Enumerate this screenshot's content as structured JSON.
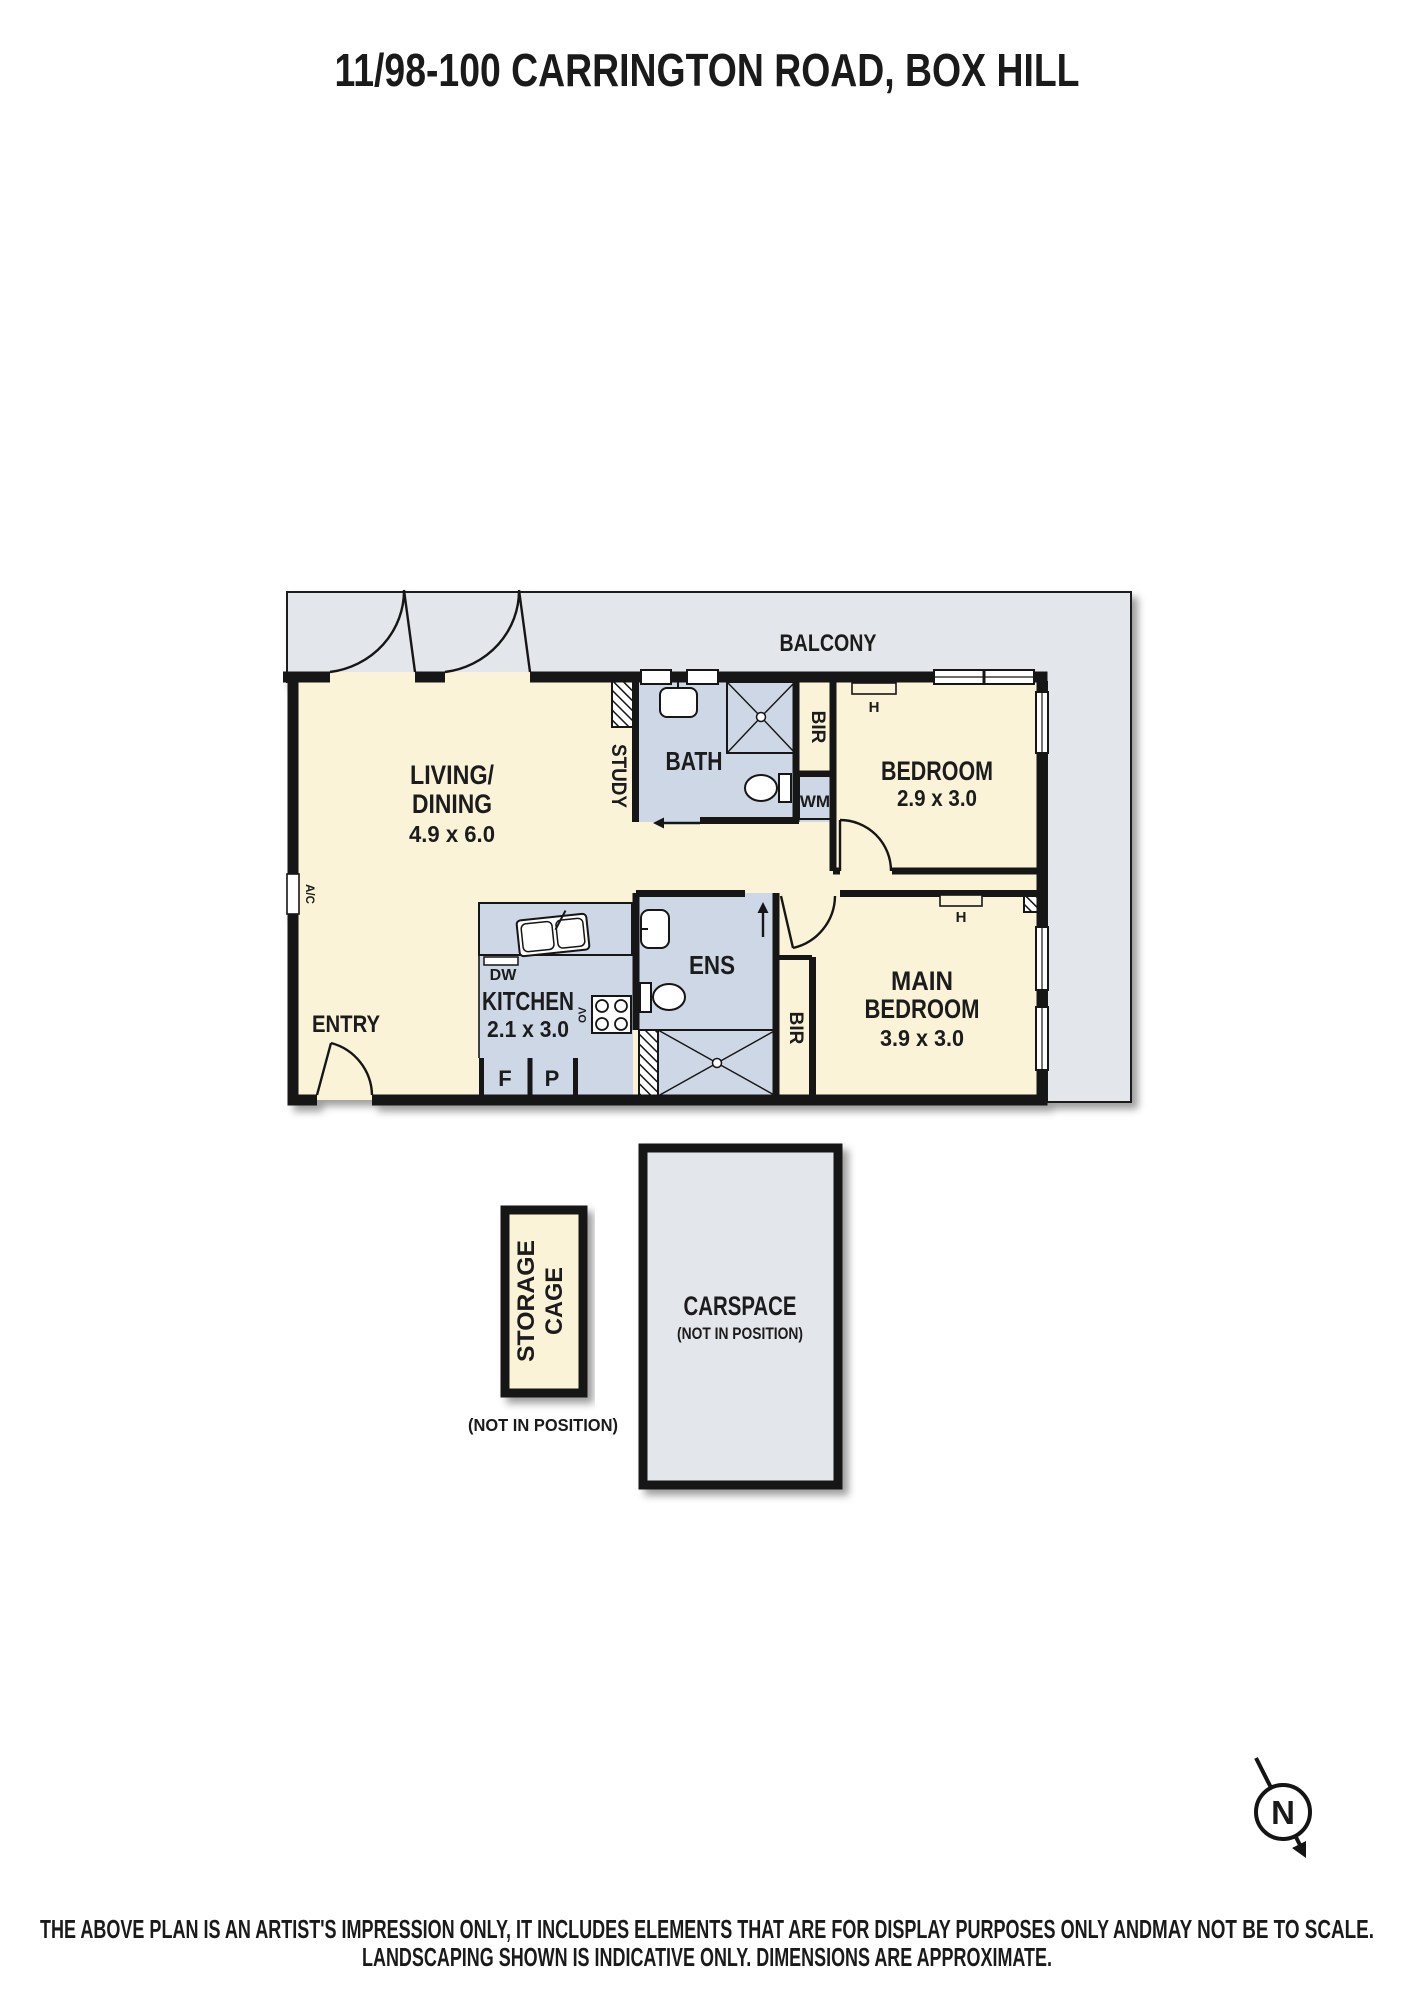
{
  "title": "11/98-100 CARRINGTON ROAD, BOX HILL",
  "plan": {
    "balcony": "BALCONY",
    "living": {
      "name1": "LIVING/",
      "name2": "DINING",
      "dims": "4.9 x 6.0"
    },
    "study": "STUDY",
    "bath": "BATH",
    "bedroom": {
      "name": "BEDROOM",
      "dims": "2.9 x 3.0",
      "heater": "H"
    },
    "main_bedroom": {
      "name1": "MAIN",
      "name2": "BEDROOM",
      "dims": "3.9 x 3.0",
      "heater": "H"
    },
    "kitchen": {
      "name": "KITCHEN",
      "dims": "2.1 x 3.0"
    },
    "ens": "ENS",
    "entry": "ENTRY",
    "fixtures": {
      "bir": "BIR",
      "wm": "WM",
      "dw": "DW",
      "oven": "OV",
      "fridge": "F",
      "pantry": "P",
      "ac": "A/C"
    }
  },
  "storage_cage": {
    "line1": "STORAGE",
    "line2": "CAGE",
    "note": "(NOT IN POSITION)"
  },
  "carspace": {
    "label": "CARSPACE",
    "note": "(NOT IN POSITION)"
  },
  "compass": {
    "n": "N"
  },
  "disclaimer": {
    "line1": "THE ABOVE PLAN IS AN ARTIST'S IMPRESSION ONLY, IT INCLUDES ELEMENTS THAT ARE FOR DISPLAY PURPOSES ONLY AND ",
    "line1_scale": "MAY NOT BE TO SCALE.",
    "line2": "LANDSCAPING SHOWN IS INDICATIVE ONLY. DIMENSIONS ARE APPROXIMATE."
  },
  "colors": {
    "room_cream": "#FAF3D8",
    "wet_blue": "#CDD7E5",
    "outdoor_gray": "#E3E6EB",
    "wall": "#141414",
    "muted_text": "#9C9C9C"
  }
}
